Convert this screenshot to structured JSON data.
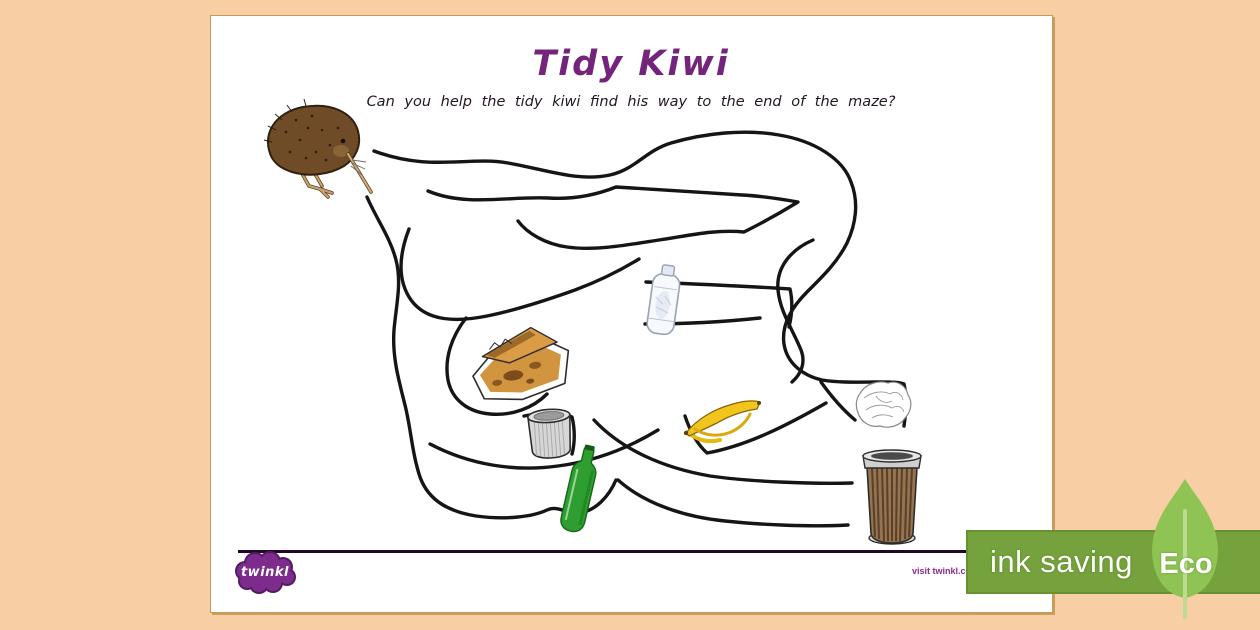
{
  "worksheet": {
    "title": "Tidy Kiwi",
    "instruction": "Can you help the tidy kiwi find his way to the end of the maze?"
  },
  "maze": {
    "start_icon": "kiwi-bird",
    "end_icon": "trash-can",
    "litter_icons": [
      "plastic-bottle",
      "pizza-box",
      "tin-can",
      "glass-bottle",
      "banana-peel",
      "crumpled-paper"
    ]
  },
  "footer": {
    "logo": "twinkl",
    "visit_link": "visit twinkl.com"
  },
  "eco_badge": {
    "label": "ink saving",
    "eco": "Eco"
  },
  "colors": {
    "background": "#f8cfa4",
    "page": "#ffffff",
    "maze_line": "#151515",
    "title": "#75247b",
    "instruction_text": "#241524",
    "footer_line": "#20082a",
    "twinkl_purple": "#7e2b8e",
    "badge_green": "#75a23c",
    "leaf_green": "#8fc353",
    "badge_text": "#ffffff"
  }
}
